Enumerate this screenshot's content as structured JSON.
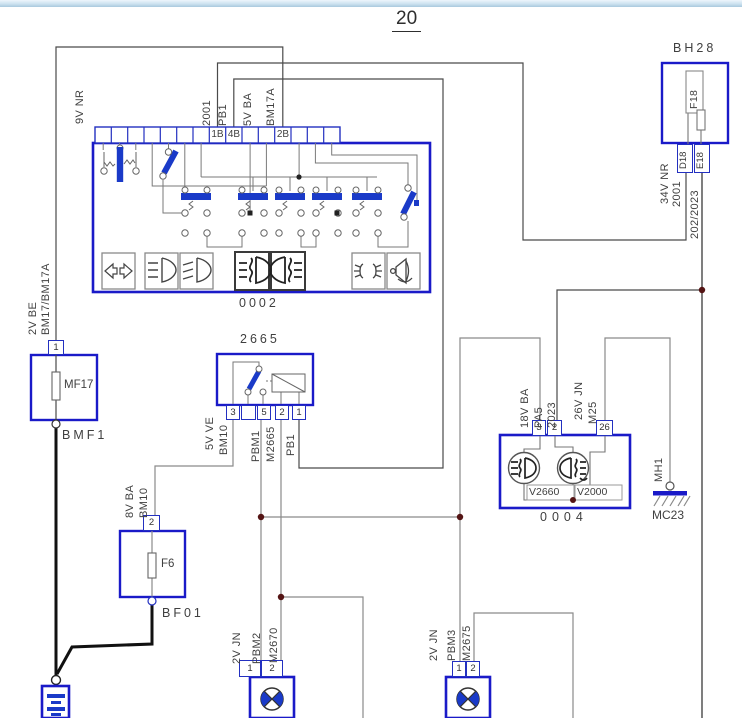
{
  "page": {
    "title": "20"
  },
  "bh28": {
    "name": "BH28",
    "fuse": "F18",
    "pin_d": "D18",
    "pin_e": "E18"
  },
  "column_switch": {
    "id": "0002",
    "pin_1b": "1B",
    "pin_4b": "4B",
    "pin_2b": "2B"
  },
  "relay": {
    "id": "2665",
    "pin3": "3",
    "pin5": "5",
    "pin2": "2",
    "pin1": "1"
  },
  "cluster": {
    "id": "0004",
    "pin3": "3",
    "pin2": "2",
    "pin26": "26",
    "lamp_front": "V2660",
    "lamp_rear": "V2000"
  },
  "fuse_mf17": {
    "pin": "1",
    "fuse": "MF17",
    "node": "BMF1"
  },
  "fuse_f6": {
    "pin": "2",
    "fuse": "F6",
    "node": "BF01"
  },
  "ground": {
    "wire": "MH1",
    "id": "MC23"
  },
  "lamp_left": {
    "pin1": "1",
    "pin2": "2"
  },
  "lamp_right": {
    "pin1": "1",
    "pin2": "2"
  },
  "wires": {
    "w_9v_nr": "9V NR",
    "w_2001_top": "2001",
    "w_pb1_top": "PB1",
    "w_5v_ba": "5V BA",
    "w_bm17a": "BM17A",
    "w_2v_be": "2V BE",
    "w_bm17_bm17a": "BM17/BM17A",
    "w_34v_nr": "34V NR",
    "w_2001_r": "2001",
    "w_202_2023": "202/2023",
    "w_5v_ve": "5V VE",
    "w_bm10_a": "BM10",
    "w_pbm1": "PBM1",
    "w_m2665": "M2665",
    "w_pb1": "PB1",
    "w_8v_ba": "8V BA",
    "w_bm10_b": "BM10",
    "w_18v_ba": "18V BA",
    "w_pa5": "PA5",
    "w_2023": "2023",
    "w_26v_jn": "26V JN",
    "w_m25": "M25",
    "w_2v_jn_l": "2V JN",
    "w_pbm2": "PBM2",
    "w_m2670": "M2670",
    "w_2v_jn_r": "2V JN",
    "w_pbm3": "PBM3",
    "w_m2675": "M2675"
  },
  "icons": {
    "turn_signal": "turn-signal-arrows",
    "low_beam": "low-beam-headlight",
    "high_beam": "high-beam-headlight",
    "front_fog": "front-fog-light",
    "rear_fog": "rear-fog-light",
    "position_lamps": "position-lamps",
    "horn": "horn",
    "bulb": "bulb-cross",
    "battery": "battery-plates",
    "ground": "chassis-ground"
  },
  "colors": {
    "component_border": "#1a1ac8",
    "wire_dark": "#3c3c3c",
    "wire_gray": "#8a8a8a",
    "junction_dot": "#541414",
    "lever_blue": "#1a3ac8"
  }
}
